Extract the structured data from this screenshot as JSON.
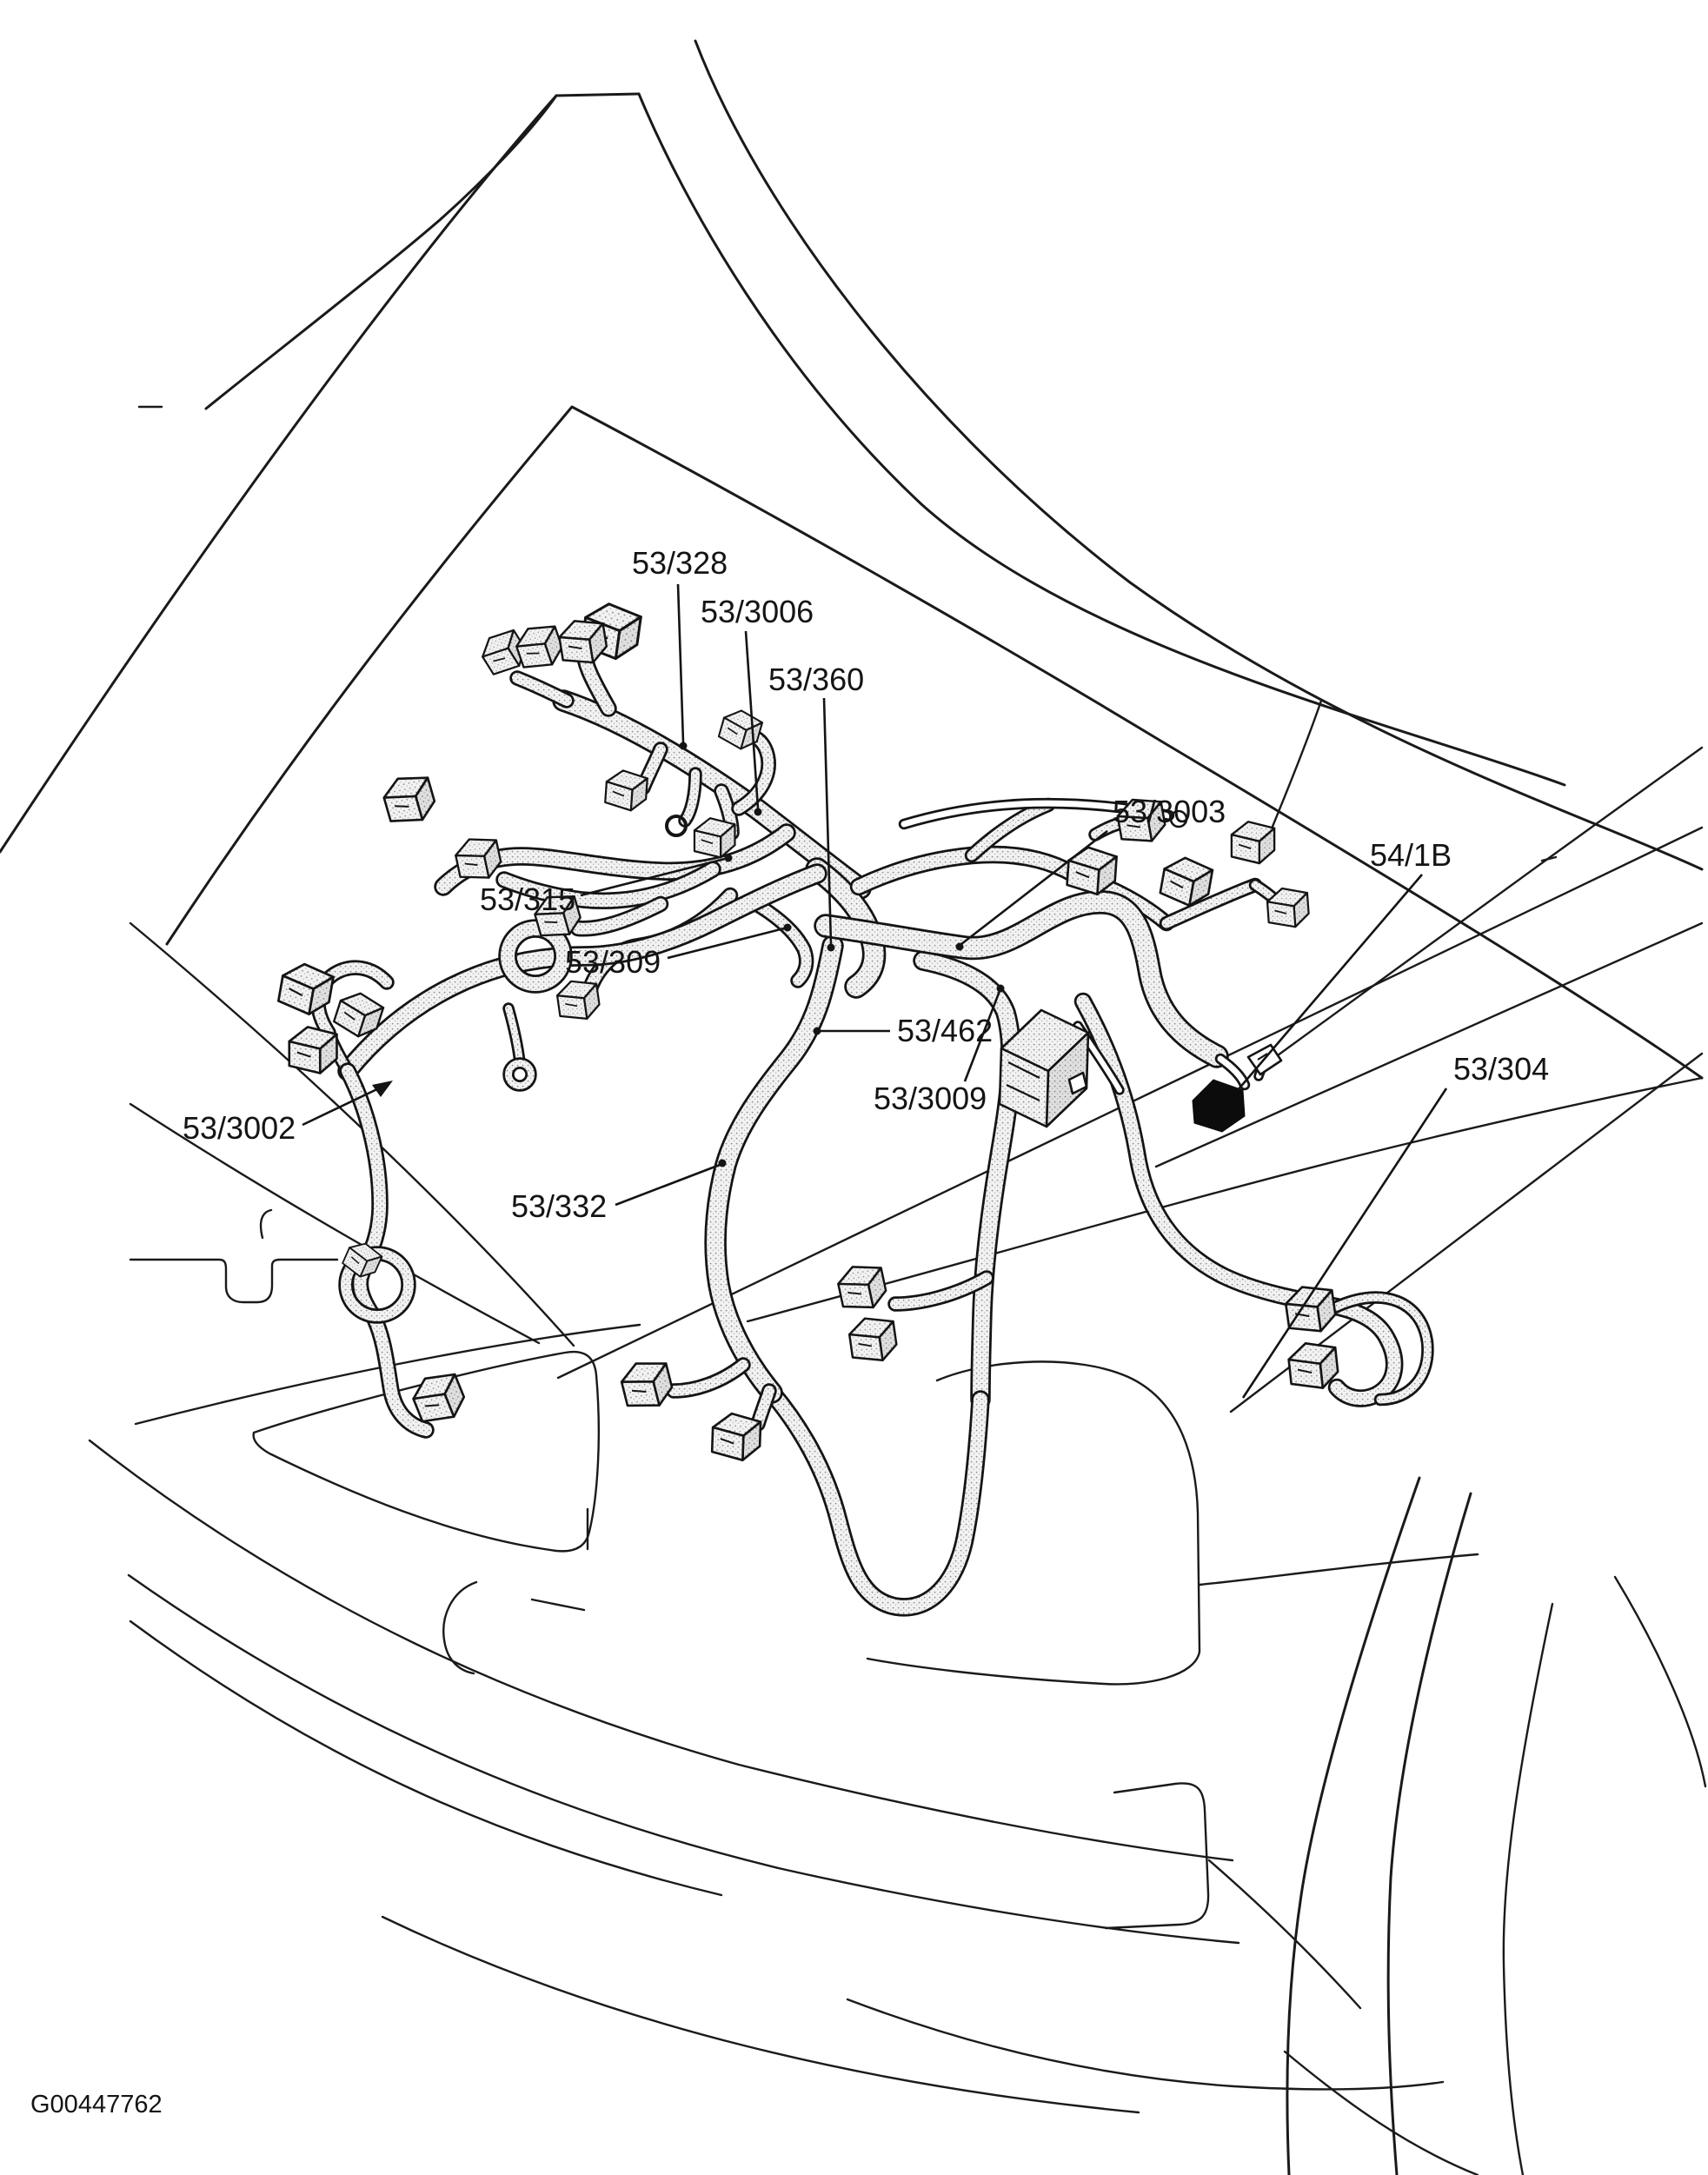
{
  "figure": {
    "kind": "engine-compartment wiring harness line diagram",
    "background_color": "#ffffff",
    "line_color": "#1a1a1a",
    "harness_fill_color": "#f2f2f2",
    "figure_id": "G00447762"
  },
  "callouts": [
    {
      "text": "53/328"
    },
    {
      "text": "53/3006"
    },
    {
      "text": "53/360"
    },
    {
      "text": "53/3003"
    },
    {
      "text": "54/1B"
    },
    {
      "text": "53/315"
    },
    {
      "text": "53/309"
    },
    {
      "text": "53/462"
    },
    {
      "text": "53/3009"
    },
    {
      "text": "53/3002"
    },
    {
      "text": "53/332"
    },
    {
      "text": "53/304"
    }
  ]
}
